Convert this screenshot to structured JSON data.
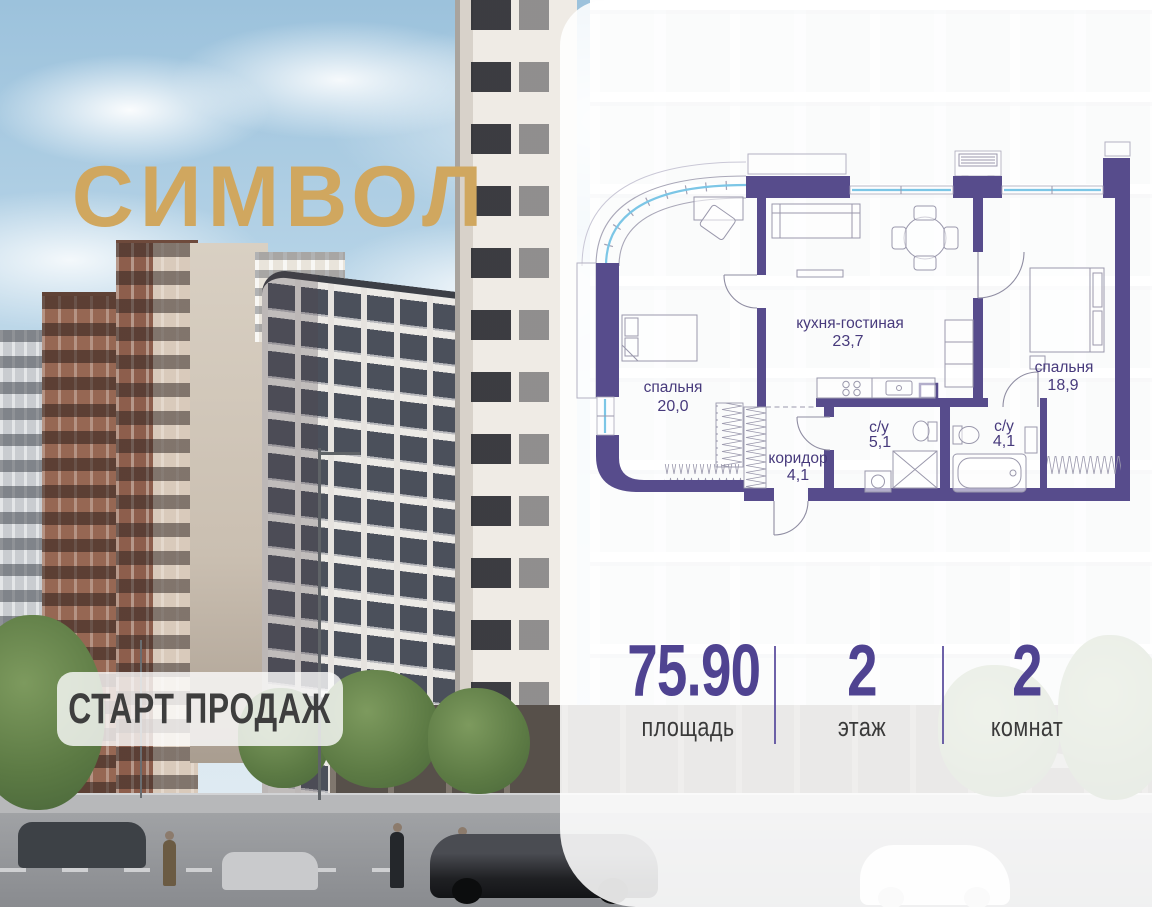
{
  "brand": {
    "logo_text": "СИМВОЛ",
    "banner_text": "СТАРТ ПРОДАЖ"
  },
  "floor_plan": {
    "rooms": [
      {
        "name": "спальня",
        "area": "20,0"
      },
      {
        "name": "кухня-гостиная",
        "area": "23,7"
      },
      {
        "name": "спальня",
        "area": "18,9"
      },
      {
        "name": "коридор",
        "area": "4,1"
      },
      {
        "name": "с/у",
        "area": "5,1"
      },
      {
        "name": "с/у",
        "area": "4,1"
      }
    ]
  },
  "stats": {
    "items": [
      {
        "value": "75.90",
        "label": "площадь"
      },
      {
        "value": "2",
        "label": "этаж"
      },
      {
        "value": "2",
        "label": "комнат"
      }
    ]
  },
  "photo": {
    "storefront_sign": "БАРБЕРШОП"
  },
  "colors": {
    "wall": "#574c8c",
    "accent_gold": "#d0a75f",
    "stat_number": "#4f4391",
    "stat_label": "#3a3a3a",
    "room_label": "#473a7c",
    "glazing": "#7cc6e6",
    "banner_text": "#3e3e3e"
  }
}
